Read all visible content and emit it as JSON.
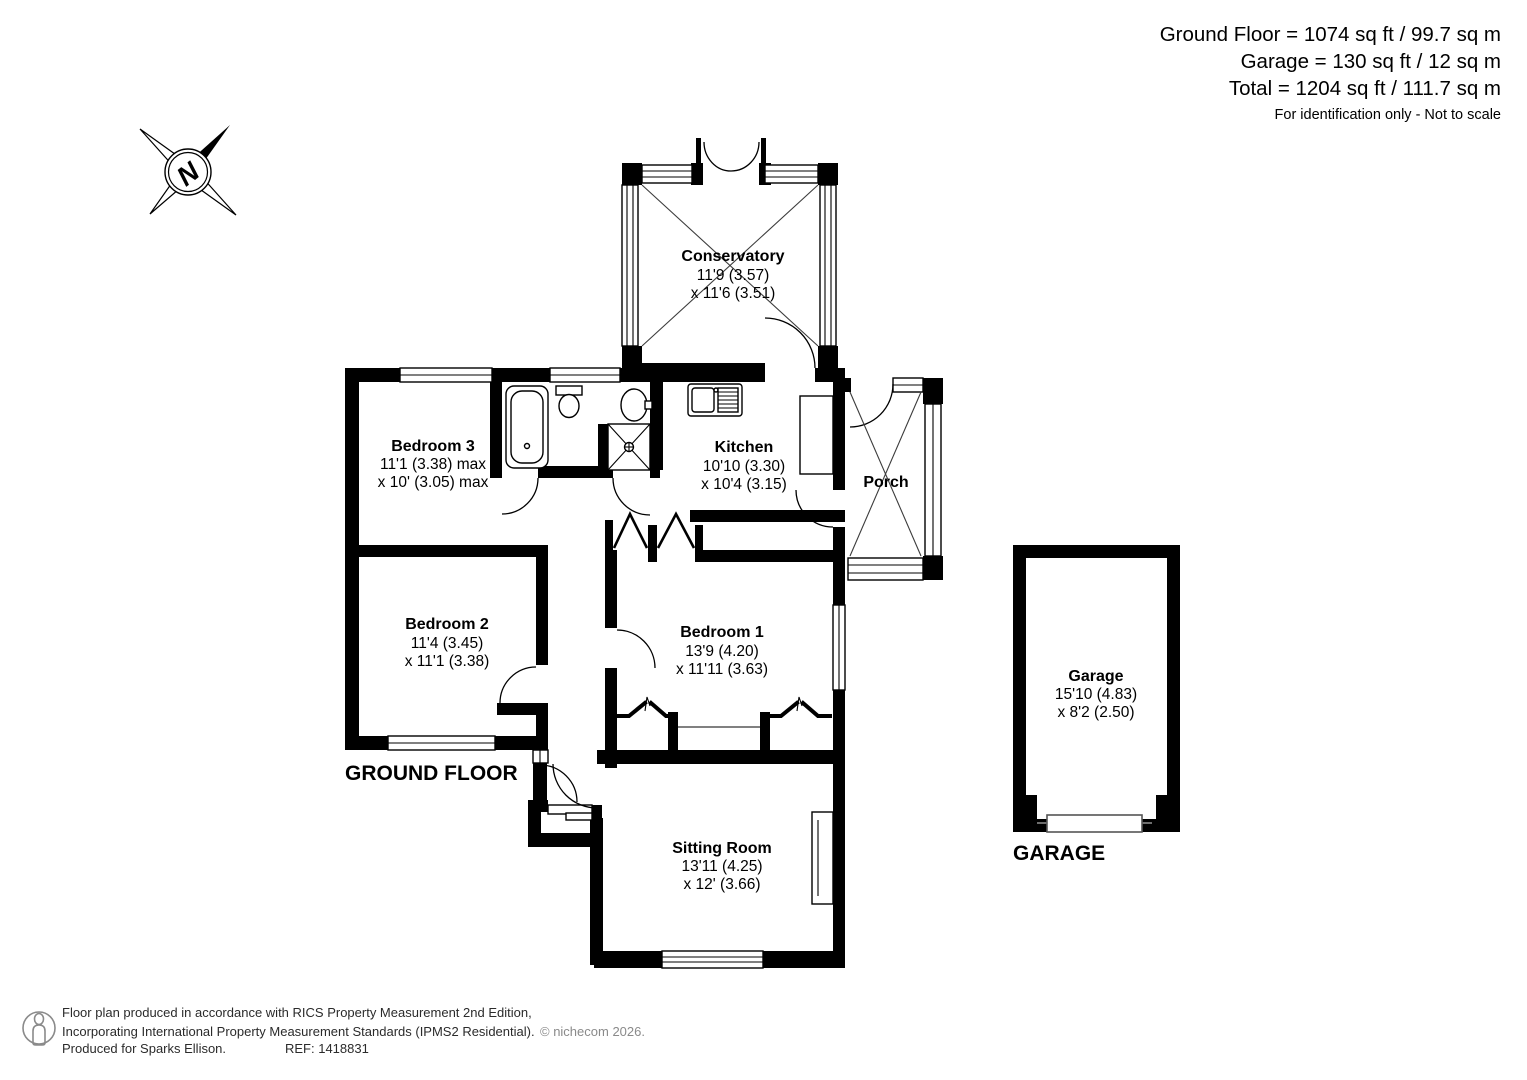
{
  "header": {
    "line1": "Ground Floor = 1074 sq ft / 99.7 sq m",
    "line2": "Garage = 130 sq ft / 12 sq m",
    "line3": "Total = 1204 sq ft / 111.7 sq m",
    "note": "For identification only - Not to scale"
  },
  "compass": {
    "north": "N"
  },
  "plan": {
    "ground_floor_label": "GROUND FLOOR",
    "garage_label": "GARAGE"
  },
  "rooms": {
    "conservatory": {
      "name": "Conservatory",
      "dim1": "11'9 (3.57)",
      "dim2": "x 11'6 (3.51)"
    },
    "kitchen": {
      "name": "Kitchen",
      "dim1": "10'10 (3.30)",
      "dim2": "x 10'4 (3.15)"
    },
    "porch": {
      "name": "Porch"
    },
    "bedroom3": {
      "name": "Bedroom 3",
      "dim1": "11'1 (3.38) max",
      "dim2": "x 10' (3.05) max"
    },
    "bedroom2": {
      "name": "Bedroom 2",
      "dim1": "11'4 (3.45)",
      "dim2": "x 11'1 (3.38)"
    },
    "bedroom1": {
      "name": "Bedroom 1",
      "dim1": "13'9 (4.20)",
      "dim2": "x 11'11 (3.63)"
    },
    "sitting_room": {
      "name": "Sitting Room",
      "dim1": "13'11 (4.25)",
      "dim2": "x 12' (3.66)"
    },
    "garage": {
      "name": "Garage",
      "dim1": "15'10 (4.83)",
      "dim2": "x 8'2 (2.50)"
    }
  },
  "footer": {
    "line1": "Floor plan produced in accordance with RICS Property Measurement 2nd Edition,",
    "line2": "Incorporating International Property Measurement Standards (IPMS2 Residential).",
    "copyright": "© nichecom 2026.",
    "line3": "Produced for Sparks Ellison.",
    "ref": "REF: 1418831"
  }
}
